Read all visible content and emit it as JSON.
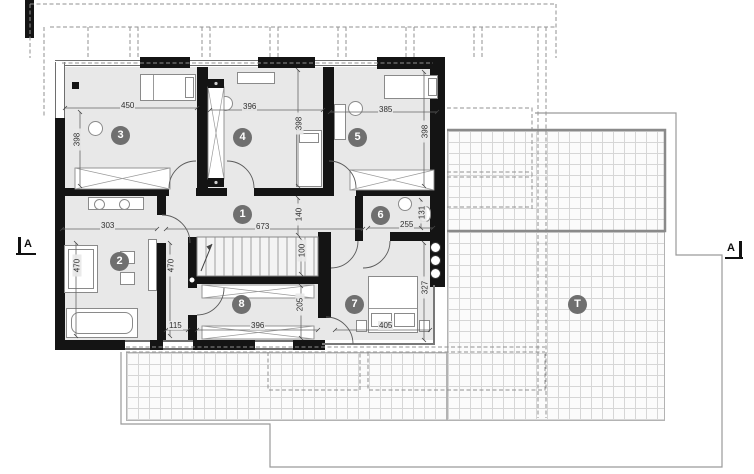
{
  "rooms": {
    "r1": "1",
    "r2": "2",
    "r3": "3",
    "r4": "4",
    "r5": "5",
    "r6": "6",
    "r7": "7",
    "r8": "8",
    "terrace": "T"
  },
  "sections": {
    "left": "A",
    "right": "A"
  },
  "dims": {
    "room3_w": "450",
    "room3_h": "398",
    "room4_w": "396",
    "room4_h": "398",
    "room5_w": "385",
    "room5_h": "398",
    "room2_w": "303",
    "hall_len": "673",
    "hall_w": "140",
    "bath6_w": "255",
    "bath6_d": "131",
    "bath2_l": "470",
    "bath2_r": "470",
    "stair_w": "100",
    "room8_h": "205",
    "room8_w": "396",
    "nook_w": "115",
    "room7_h": "327",
    "room7_w": "405"
  },
  "colors": {
    "wall": "#141414",
    "floor": "#e8e8e8",
    "room_badge": "#6f6f6f",
    "grid_line": "#d6d6d6",
    "dash_line": "#909090"
  }
}
